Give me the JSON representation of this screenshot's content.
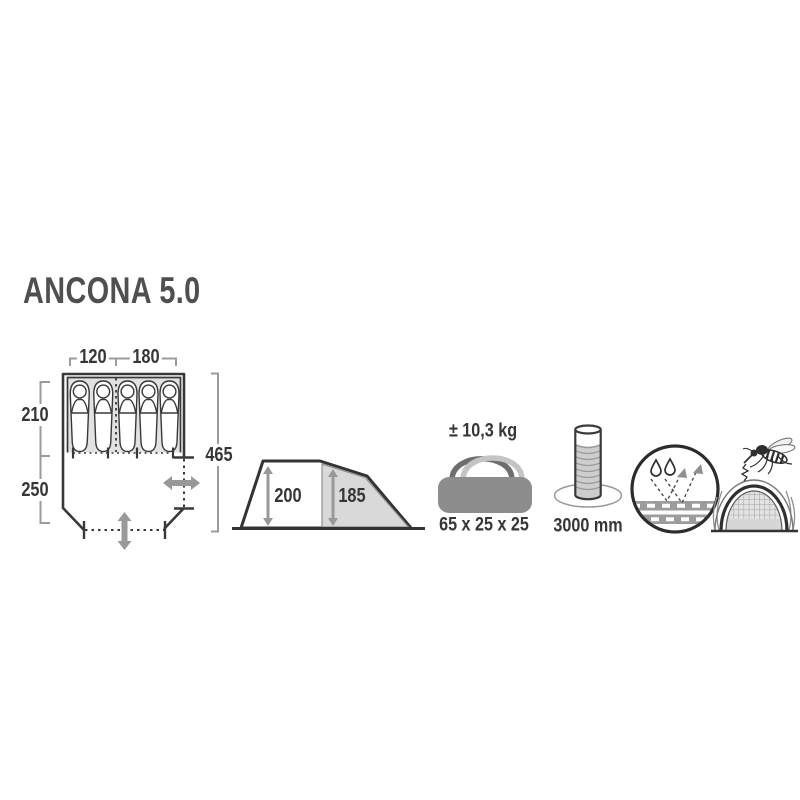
{
  "title": "ANCONA 5.0",
  "floor_plan": {
    "width_left": "120",
    "width_right": "180",
    "depth_sleeping": "210",
    "depth_porch": "250",
    "total_length": "465",
    "sleeping_bags_left": 2,
    "sleeping_bags_right": 3
  },
  "side_view": {
    "height_front": "200",
    "height_rear": "185"
  },
  "specs": {
    "weight": "± 10,3 kg",
    "pack_size": "65 x 25 x 25",
    "water_column": "3000 mm"
  },
  "icons": [
    "carry-bag-icon",
    "water-column-icon",
    "waterproof-fabric-icon",
    "mosquito-net-icon"
  ],
  "colors": {
    "outline": "#383838",
    "text": "#363636",
    "title": "#4f4f4f",
    "mid_gray": "#999999",
    "light_gray": "#e2e2e2",
    "panel_gray": "#d9d9d9",
    "bag_gray": "#8d8d8d"
  }
}
